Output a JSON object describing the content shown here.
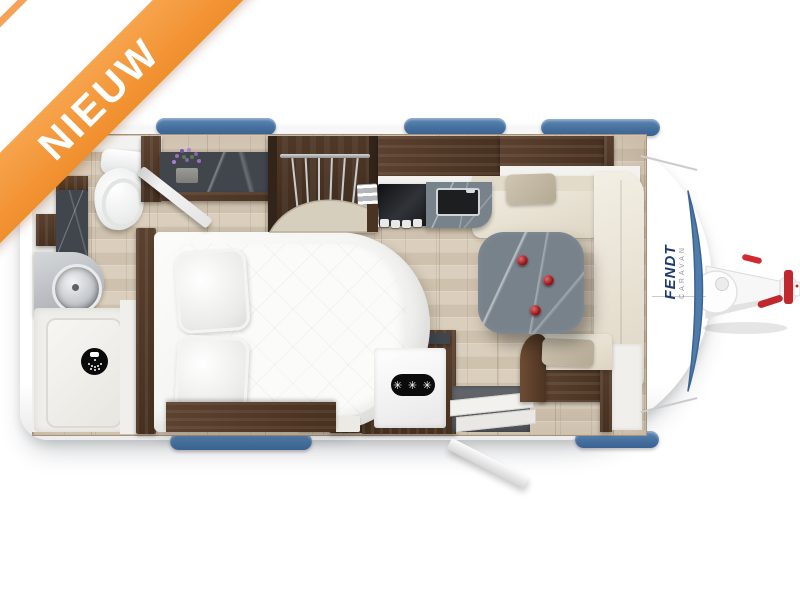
{
  "banner": {
    "label": "NIEUW",
    "band_color": "#F3973C",
    "text_color": "#FFFFFF"
  },
  "brand": {
    "logo": "FENDT",
    "logo_sub": "CARAVAN",
    "logo_color": "#1D3A6E"
  },
  "fridge": {
    "star_rating": "✳ ✳ ✳"
  },
  "colors": {
    "trim_blue": "#4A76A6",
    "window_blue": "#46719F",
    "wood_dark": "#4A3526",
    "marble_dark": "#41464D",
    "marble_table": "#78828B",
    "floor_wood": "#D8CCBA",
    "upholstery_cream": "#EDE7D8",
    "accent_red": "#C1272D"
  },
  "floorplan": {
    "vehicle": "caravan",
    "view": "top-down",
    "zones": [
      "washroom-with-toilet-sink-shower",
      "french-bed-with-two-pillows",
      "wardrobe-with-hanging-rail",
      "kitchen-with-stove-and-sink",
      "refrigerator-with-freezer-stars",
      "entry-door-open",
      "u-shaped-dinette-with-table",
      "front-drawbar-hitch"
    ],
    "icons": [
      "shower-icon",
      "freezer-stars-badge",
      "flower-pot-icon"
    ]
  }
}
